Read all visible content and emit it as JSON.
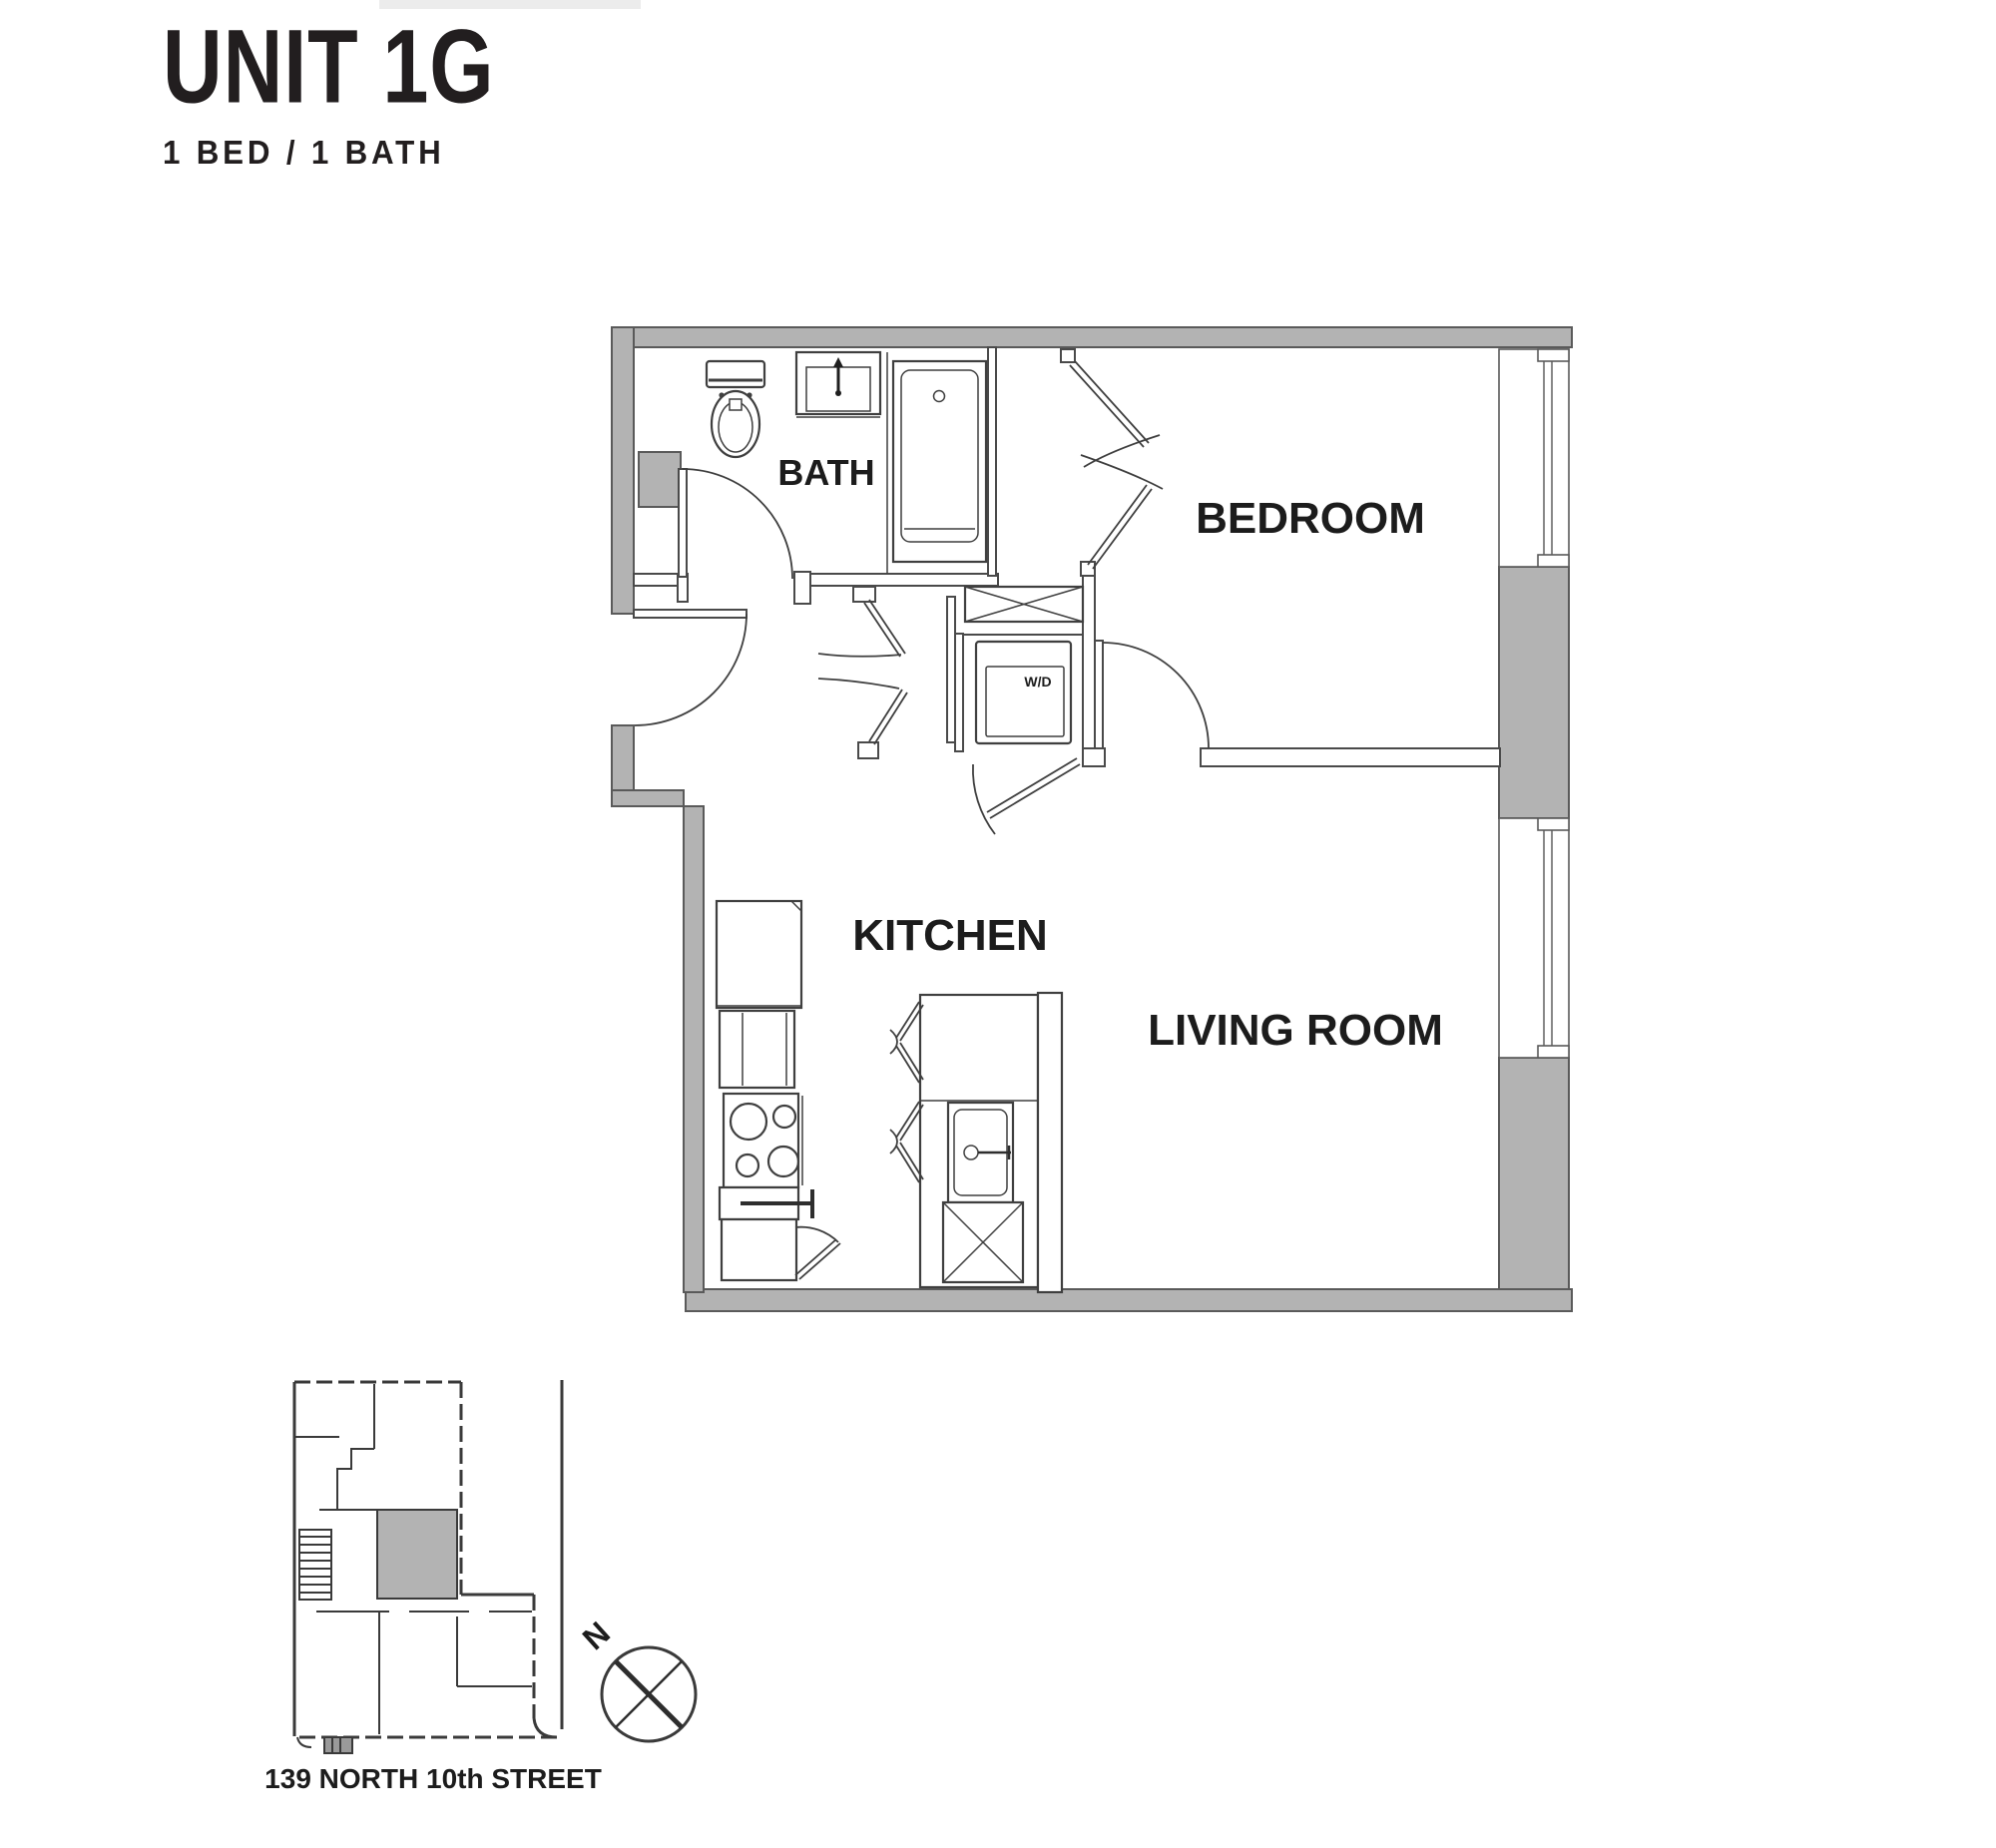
{
  "header": {
    "title": "UNIT 1G",
    "subtitle": "1 BED / 1 BATH"
  },
  "floor_plan": {
    "rooms": [
      {
        "name": "BATH"
      },
      {
        "name": "BEDROOM"
      },
      {
        "name": "KITCHEN"
      },
      {
        "name": "LIVING ROOM"
      }
    ],
    "labels": {
      "washer_dryer": "W/D"
    },
    "icons": [
      "toilet-icon",
      "bathroom-sink-icon",
      "bathtub-icon",
      "entry-door-swing",
      "bath-door-swing",
      "bedroom-door-swing",
      "hall-door-swing",
      "bedroom-closet-bifold-doors",
      "hall-closet-bifold-doors",
      "linen-closet-x",
      "washer-dryer-unit",
      "refrigerator-icon",
      "range-4-burner-icon",
      "oven-handle",
      "base-cabinet-door-swing",
      "island-sink-with-faucet",
      "island-x-cabinet",
      "window-bedroom",
      "window-living-room"
    ]
  },
  "site_plan": {
    "address": "139 NORTH 10th STREET",
    "compass_label": "N",
    "icons": [
      "building-key-plan",
      "highlighted-unit-shaded",
      "stair-hatch",
      "north-compass-icon",
      "property-line"
    ]
  },
  "colors": {
    "wall_fill": "#b3b3b3",
    "line": "#3f3f3f",
    "text": "#1c1c1c",
    "background": "#ffffff"
  }
}
